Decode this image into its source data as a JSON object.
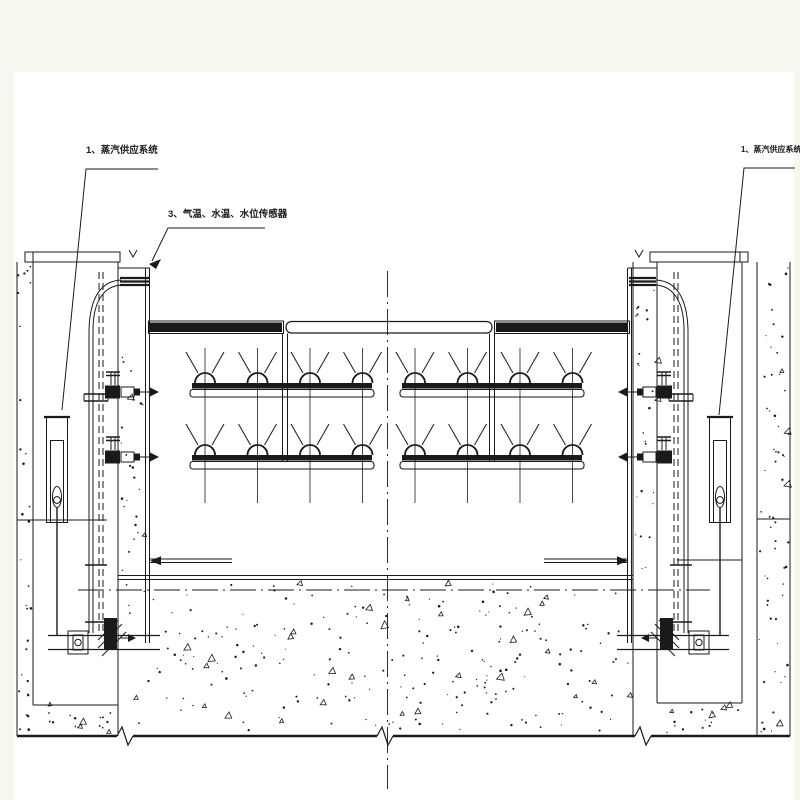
{
  "drawing": {
    "title_hint": "steam de-icing gate elevation",
    "labels": {
      "steam_supply_left": "1、蒸汽供应系统",
      "sensors": "3、气温、水温、水位传感器",
      "steam_supply_right": "1、蒸汽供应系统"
    },
    "colors": {
      "page_bg": "#f6f8f0",
      "paper": "#ffffff",
      "ink": "#1a1a1a"
    }
  }
}
